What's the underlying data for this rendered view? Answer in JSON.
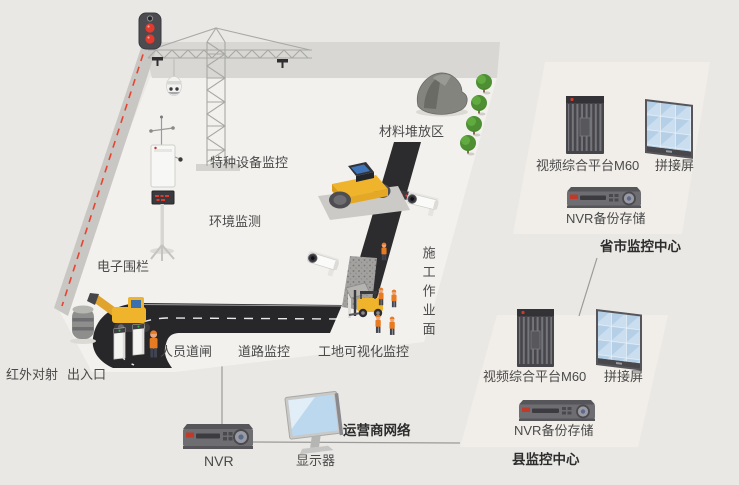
{
  "colors": {
    "background": "#eae8e4",
    "site_ground": "#f3f1ee",
    "top_wall": "#d9d7d3",
    "side_wall": "#c9c7c3",
    "panel": "#f1eee9",
    "fence_red": "#e8432f",
    "road_black": "#27272a",
    "machine_yellow": "#f0b42c",
    "cab_blue": "#3f74b8",
    "screen_blue": "#b9d3e9",
    "tree_green": "#4d8f32",
    "label_text": "#4a4a4a",
    "connector_line": "#9a9a98"
  },
  "site": {
    "labels": {
      "special_equipment": "特种设备监控",
      "environment": "环境监测",
      "electronic_fence": "电子围栏",
      "material_area": "材料堆放区",
      "work_surface": "施工作业面",
      "infrared": "红外对射",
      "entrance": "出入口",
      "personnel_gate": "人员道闸",
      "road_monitor": "道路监控",
      "site_visual": "工地可视化监控"
    }
  },
  "network": {
    "nvr": "NVR",
    "monitor": "显示器",
    "carrier": "运营商网络"
  },
  "centers": {
    "province": {
      "platform": "视频综合平台M60",
      "video_wall": "拼接屏",
      "nvr_backup": "NVR备份存储",
      "title": "省市监控中心"
    },
    "county": {
      "platform": "视频综合平台M60",
      "video_wall": "拼接屏",
      "nvr_backup": "NVR备份存储",
      "title": "县监控中心"
    }
  }
}
